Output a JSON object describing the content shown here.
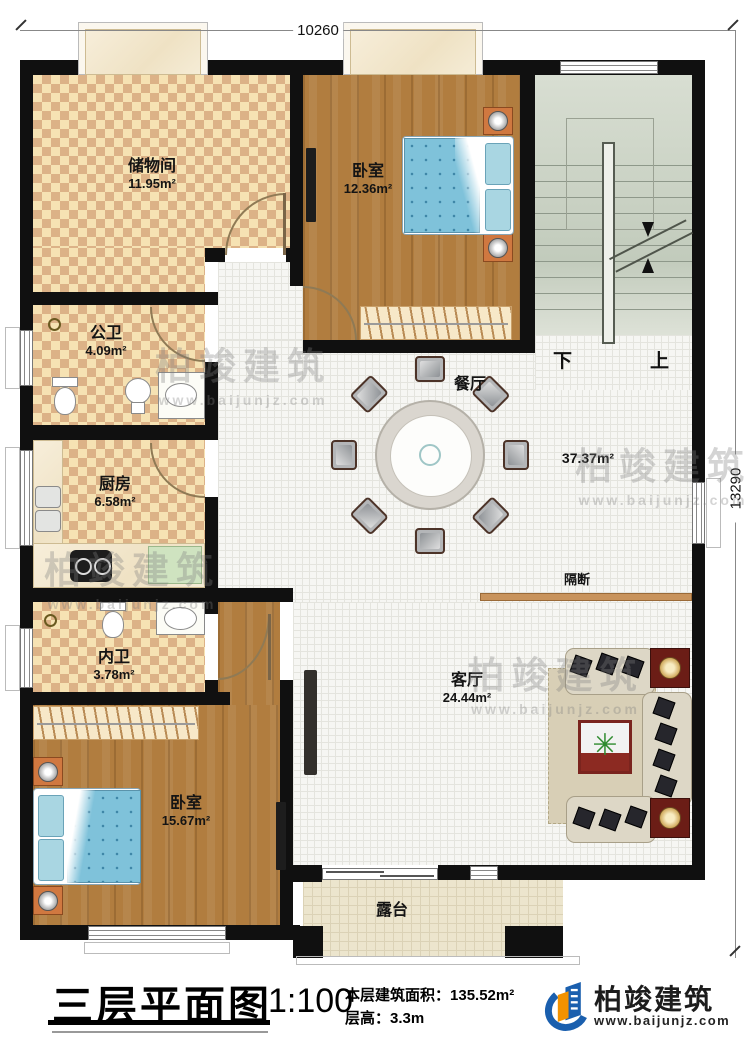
{
  "dimensions": {
    "top": "10260",
    "right": "13290"
  },
  "rooms": {
    "storage": {
      "name": "储物间",
      "area": "11.95m²"
    },
    "bedroom_top": {
      "name": "卧室",
      "area": "12.36m²"
    },
    "public_bath": {
      "name": "公卫",
      "area": "4.09m²"
    },
    "kitchen": {
      "name": "厨房",
      "area": "6.58m²"
    },
    "ensuite_bath": {
      "name": "内卫",
      "area": "3.78m²"
    },
    "bedroom_main": {
      "name": "卧室",
      "area": "15.67m²"
    },
    "dining": {
      "name": "餐厅"
    },
    "hall_area": "37.37m²",
    "living": {
      "name": "客厅",
      "area": "24.44m²"
    },
    "terrace": {
      "name": "露台"
    },
    "partition": {
      "name": "隔断"
    }
  },
  "stairs": {
    "down": "下",
    "up": "上"
  },
  "title_block": {
    "title": "三层平面图",
    "scale": "1:100",
    "floor_area_label": "本层建筑面积：",
    "floor_area_value": "135.52m²",
    "floor_height_label": "层高：",
    "floor_height_value": "3.3m"
  },
  "branding": {
    "company": "柏竣建筑",
    "website": "www.baijunjz.com"
  },
  "watermark": {
    "text": "柏竣建筑",
    "url": "www.baijunjz.com"
  },
  "colors": {
    "wall": "#101010",
    "wood": "#b17d3f",
    "checker_light": "#f6e2b3",
    "checker_dark": "#dcb287",
    "bed": "#7fc2da",
    "stairs": "#c9d1c2",
    "partition_bar": "#c8935c",
    "logo_blue": "#1a5fae",
    "logo_orange": "#f29200"
  }
}
